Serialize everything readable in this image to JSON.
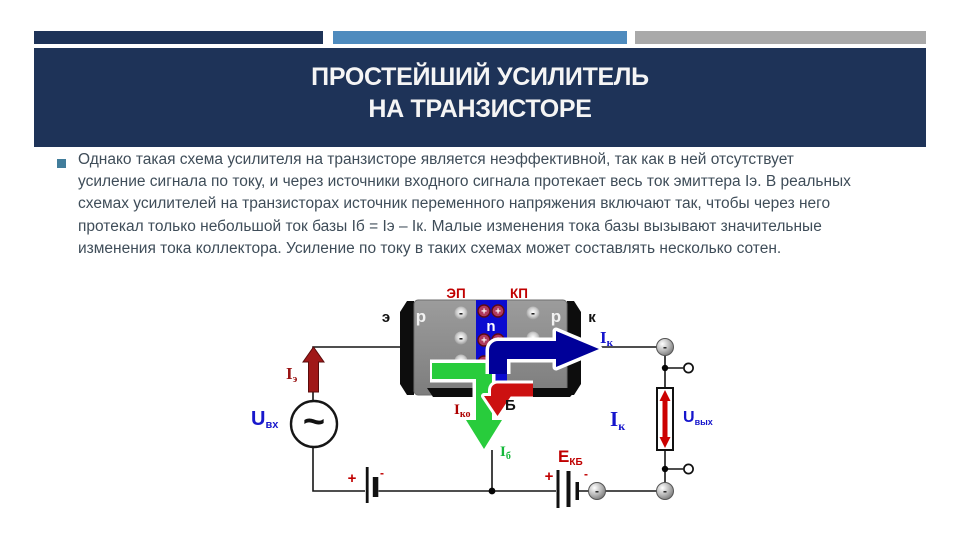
{
  "slide": {
    "title_line1": "ПРОСТЕЙШИЙ УСИЛИТЕЛЬ",
    "title_line2": "НА ТРАНЗИСТОРЕ",
    "body_lines": [
      "Однако такая схема усилителя на транзисторе является неэффективной, так как в ней отсутствует",
      "усиление сигнала по току, и через источники входного сигнала протекает весь ток эмиттера Iэ. В реальных",
      "схемах усилителей на транзисторах источник переменного напряжения включают так, чтобы через него",
      "протекал только небольшой ток базы Iб = Iэ – Iк. Малые изменения тока базы вызывают значительные",
      "изменения тока коллектора. Усиление по току в таких схемах может составлять несколько сотен."
    ]
  },
  "colors": {
    "title_bg": "#1E3358",
    "bar_navy": "#1E3358",
    "bar_blue": "#4E8BBE",
    "bar_gray": "#A9A9A9",
    "bullet": "#417D9B",
    "body_text": "#3F4D59",
    "label_red": "#C00000",
    "label_blue": "#1515CC",
    "label_green": "#15B83A",
    "arrow_green": "#28CC3C",
    "arrow_blue": "#000099",
    "arrow_red": "#CC1111",
    "n_region_blue": "#0B0BD0"
  },
  "diagram": {
    "junctions": {
      "ep": "ЭП",
      "kp": "КП"
    },
    "regions": {
      "p_left": "p",
      "n": "n",
      "p_right": "p"
    },
    "terminals": {
      "emitter": "э",
      "collector": "к",
      "base": "Б"
    },
    "currents": {
      "ie": {
        "m": "I",
        "s": "э"
      },
      "ik_top": {
        "m": "I",
        "s": "к"
      },
      "iko": {
        "m": "I",
        "s": "ко"
      },
      "ib": {
        "m": "I",
        "s": "б"
      },
      "ik_load": {
        "m": "I",
        "s": "к"
      }
    },
    "voltages": {
      "u_in": {
        "m": "U",
        "s": "вх"
      },
      "u_out": {
        "m": "U",
        "s": "вых"
      },
      "e_kb": {
        "m": "Е",
        "s": "КБ"
      }
    },
    "source_symbol": "~",
    "charge_plus": "+",
    "charge_minus": "-",
    "battery_plus": "+",
    "battery_minus": "-",
    "electron_minus": "-"
  }
}
